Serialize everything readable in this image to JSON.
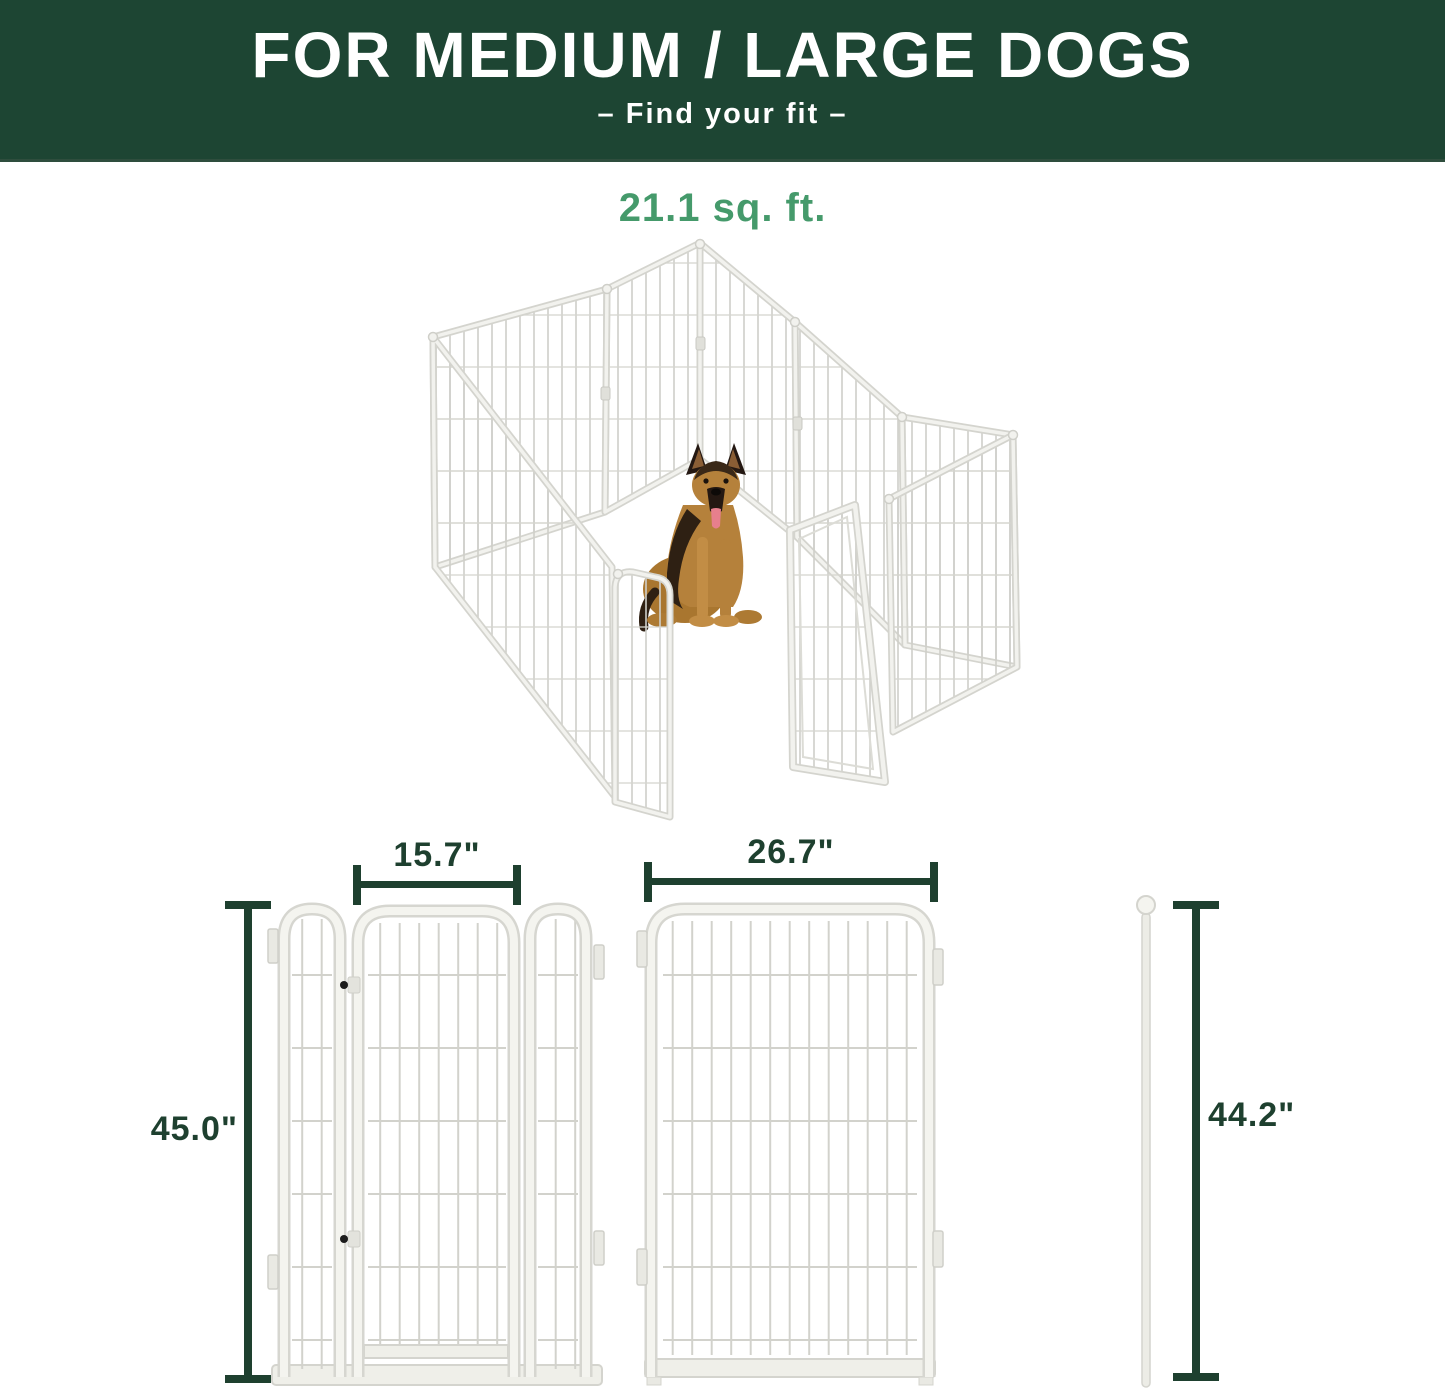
{
  "header": {
    "title": "FOR MEDIUM / LARGE DOGS",
    "subtitle": "–  Find your fit  –",
    "background_color": "#1d4533",
    "text_color": "#ffffff"
  },
  "pen": {
    "area_label": "21.1 sq. ft.",
    "area_label_color": "#459a6b",
    "illustration": "white-metal-8-panel-playpen-with-german-shepherd-inside"
  },
  "dimensions": {
    "gate_panel_width": "15.7\"",
    "gate_panel_height": "45.0\"",
    "regular_panel_width": "26.7\"",
    "rod_height": "44.2\"",
    "line_color": "#1e402f"
  },
  "illustration_parts": {
    "gate_panel": "gate-panel-front-diagram",
    "regular_panel": "regular-panel-front-diagram",
    "rod": "connector-rod-diagram"
  }
}
